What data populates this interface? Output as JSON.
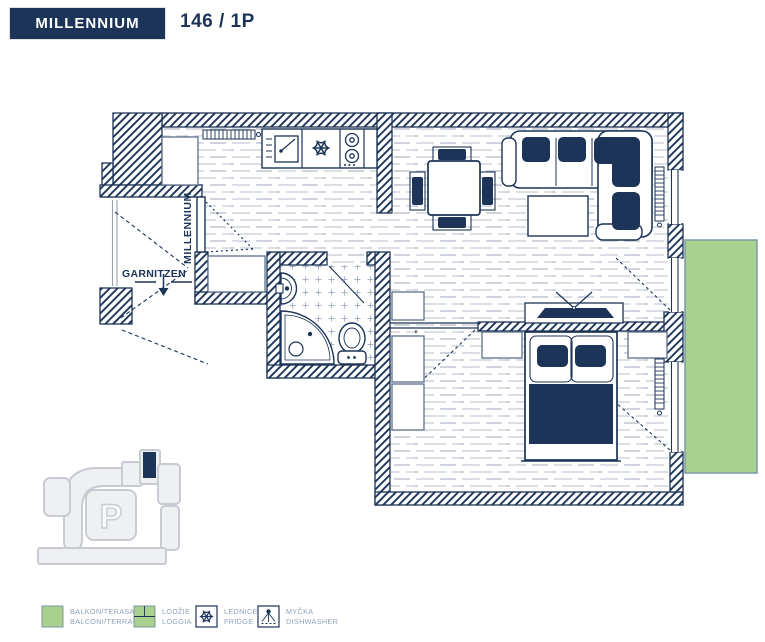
{
  "header": {
    "project_name": "MILLENNIUM",
    "unit_number": "146 / 1P"
  },
  "plan": {
    "entrance_label": "MILLENNIUM",
    "corridor_label": "GARNITZEN",
    "features": [
      "entrance-door",
      "kitchen-counter",
      "dishwasher-icon",
      "fridge-icon",
      "stove-icon",
      "dining-table",
      "sofa",
      "coffee-table",
      "tv-icon",
      "bathroom-sink",
      "corner-shower",
      "toilet",
      "double-bed",
      "wardrobes",
      "radiators",
      "balcony"
    ]
  },
  "site_map": {
    "parking_label": "P",
    "marker": "apartment-location"
  },
  "legend": {
    "items": [
      {
        "icon": "balcony-swatch",
        "line1": "BALKON/TERASA",
        "line2": "BALCONI/TERRACE"
      },
      {
        "icon": "loggia-swatch",
        "line1": "LODŽIE",
        "line2": "LOGGIA"
      },
      {
        "icon": "fridge-icon",
        "line1": "LEDNICE",
        "line2": "FRIDGE"
      },
      {
        "icon": "dishwasher-icon",
        "line1": "MYČKA",
        "line2": "DISHWASHER"
      }
    ]
  },
  "colors": {
    "navy": "#1c3457",
    "balcony_green": "#a8d08f",
    "balcony_border": "#7d98a6",
    "floor_line": "#c6ccd6",
    "tile_mark": "#a7b2c2",
    "exterior_gray": "#98a1ad",
    "map_fill": "#eef0f2",
    "map_stroke": "#c8ccd2",
    "legend_text": "#8fa3ba"
  }
}
